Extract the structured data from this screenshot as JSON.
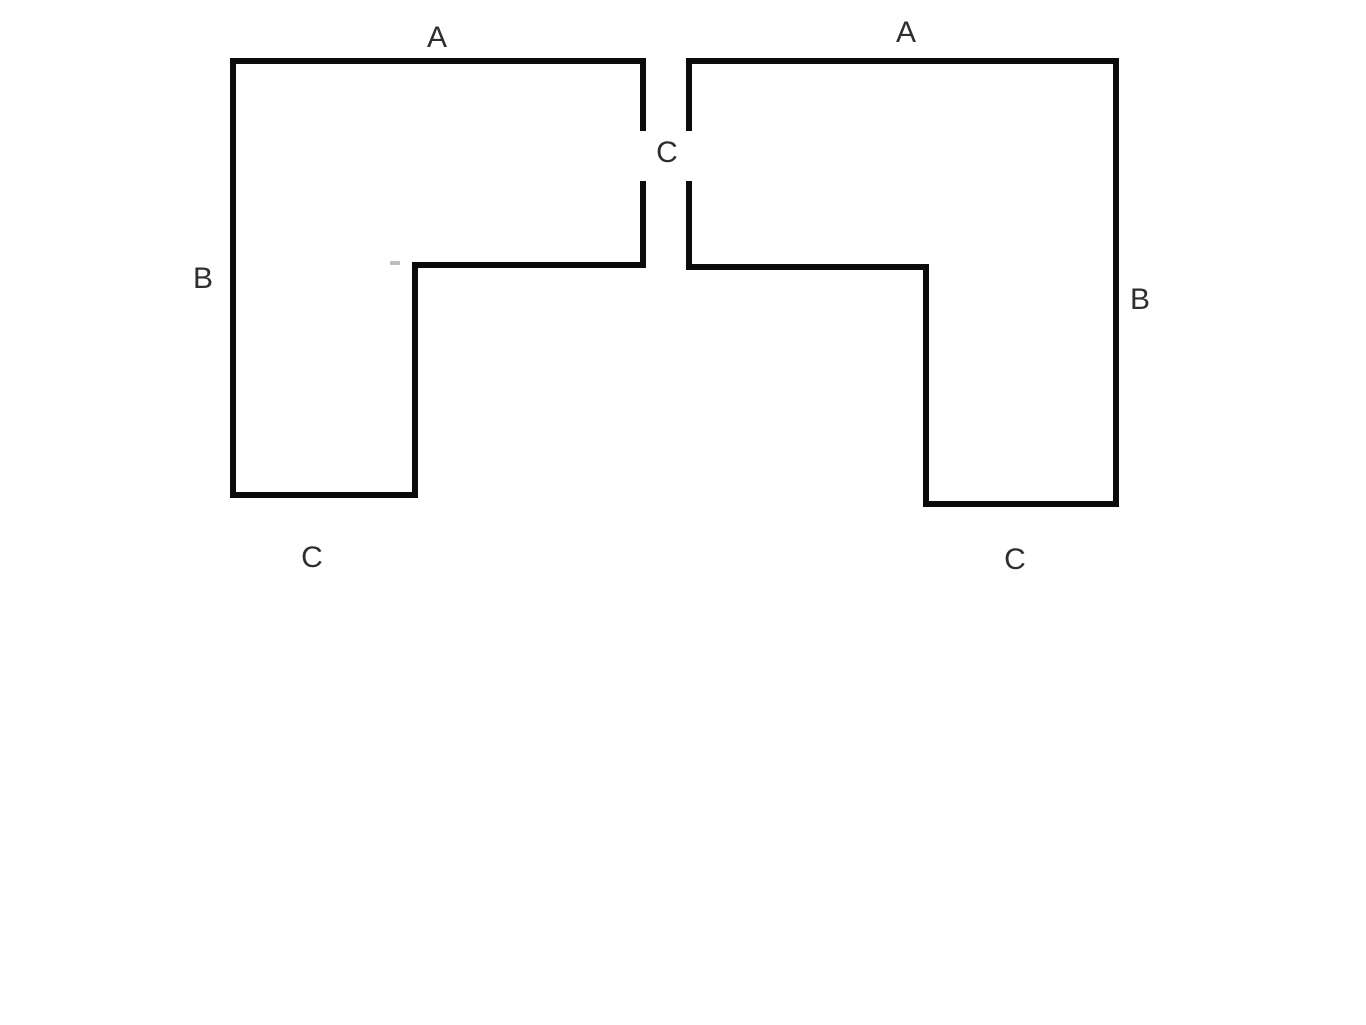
{
  "canvas": {
    "width": 1366,
    "height": 1025,
    "background": "#ffffff"
  },
  "figure": {
    "stroke_color": "#0b0b0b",
    "stroke_width": 6,
    "label_color": "#2e2e2e",
    "label_font_size": 30
  },
  "shapes": [
    {
      "name": "left-l-shape-outline",
      "points": [
        [
          643,
          181
        ],
        [
          643,
          265
        ],
        [
          415,
          265
        ],
        [
          415,
          495
        ],
        [
          233,
          495
        ],
        [
          233,
          61
        ],
        [
          643,
          61
        ],
        [
          643,
          131
        ]
      ]
    },
    {
      "name": "right-l-shape-outline",
      "points": [
        [
          689,
          181
        ],
        [
          689,
          267
        ],
        [
          926,
          267
        ],
        [
          926,
          504
        ],
        [
          1116,
          504
        ],
        [
          1116,
          61
        ],
        [
          689,
          61
        ],
        [
          689,
          131
        ]
      ]
    }
  ],
  "labels": [
    {
      "name": "label-a-left",
      "text": "A",
      "x": 437,
      "y": 38
    },
    {
      "name": "label-a-right",
      "text": "A",
      "x": 906,
      "y": 33
    },
    {
      "name": "label-c-middle",
      "text": "C",
      "x": 667,
      "y": 153
    },
    {
      "name": "label-b-left",
      "text": "B",
      "x": 203,
      "y": 279
    },
    {
      "name": "label-b-right",
      "text": "B",
      "x": 1140,
      "y": 300
    },
    {
      "name": "label-c-left-bottom",
      "text": "C",
      "x": 312,
      "y": 558
    },
    {
      "name": "label-c-right-bottom",
      "text": "C",
      "x": 1015,
      "y": 560
    }
  ],
  "artifact": {
    "name": "stray-pen-mark",
    "x": 390,
    "y": 261,
    "width": 10,
    "height": 4,
    "color": "#bdbdbd"
  }
}
